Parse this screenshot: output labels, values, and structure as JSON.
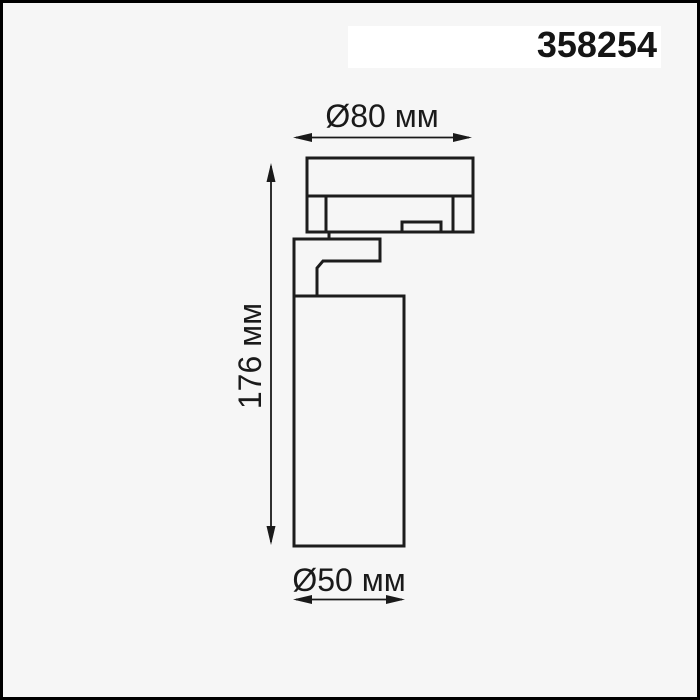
{
  "header": {
    "part_number": "358254"
  },
  "drawing": {
    "dimensions": {
      "top_width": "Ø80 мм",
      "side_height": "176 мм",
      "bottom_diameter": "Ø50 мм"
    }
  },
  "colors": {
    "background": "#f6f6f6",
    "frame_border": "#000000",
    "outline": "#1c1c1c",
    "dimension": "#1a1a1a",
    "label_background": "#ffffff",
    "label_text": "#151515"
  }
}
